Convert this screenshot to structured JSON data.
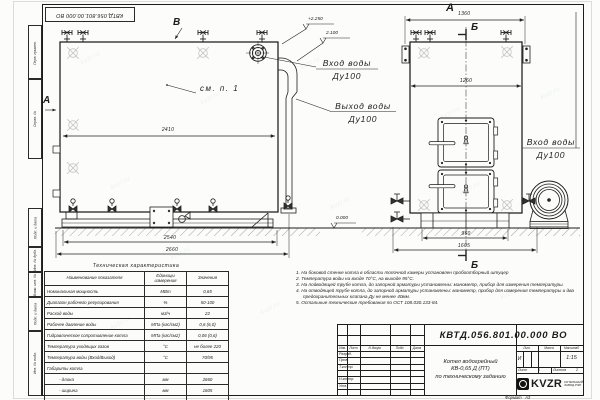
{
  "doc_number": "КВТД.056.801.00.000  ВО",
  "watermark": "kvzr.ru",
  "margin_labels": [
    "Перв. примен.",
    "Справ. №",
    "Подп. и дата",
    "Инв. № дубл.",
    "Взам. инв. №",
    "Подп. и дата",
    "Инв. № подл."
  ],
  "views": {
    "view_b": "В",
    "section_a": "А",
    "view_a": "А",
    "section_b_top": "Б",
    "section_b_bottom": "Б",
    "see_note": "см. п. 1",
    "dims": {
      "d2410": "2410",
      "d2540": "2540",
      "d2660": "2660",
      "d1360": "1360",
      "d1260": "1260",
      "d960": "960",
      "d1605": "1605"
    },
    "elevations": {
      "top": "+2.250",
      "mid": "2.100",
      "zero": "0.000"
    },
    "ports": {
      "inlet_left": [
        "Вход воды",
        "Ду100"
      ],
      "outlet": [
        "Выход воды",
        "Ду100"
      ],
      "inlet_right": [
        "Вход воды",
        "Ду100"
      ]
    }
  },
  "table": {
    "title": "Техническая характеристика",
    "headers": [
      "Наименование показателя",
      "Единицы измерения",
      "Значения"
    ],
    "rows": [
      [
        "Номинальная мощность",
        "МВт",
        "0,65"
      ],
      [
        "Диапазон рабочего регулирования",
        "%",
        "50-100"
      ],
      [
        "Расход воды",
        "м3/ч",
        "22"
      ],
      [
        "Рабочее давление воды",
        "МПа (кгс/см2)",
        "0,6 (6,0)"
      ],
      [
        "Гидравлическое сопротивление котла",
        "МПа (кгс/см2)",
        "0,06 (0,6)"
      ],
      [
        "Температура уходящих газов",
        "°С",
        "не более 220"
      ],
      [
        "Температура воды (Вход/Выход)",
        "°С",
        "70/95"
      ],
      [
        "Габариты котла",
        "",
        ""
      ],
      [
        "- длина",
        "мм",
        "2660"
      ],
      [
        "- ширина",
        "мм",
        "1605"
      ],
      [
        "- высота",
        "мм",
        "2250"
      ]
    ]
  },
  "notes": [
    "1.  На боковой стенке котла в области топочной камеры установлен пробоотборный штуцер",
    "2.  Температура воды на входе 70°С, на выходе 95°С.",
    "3.  На подводящей трубе котла, до запорной арматуры установлены: манометр, прибор для измерения температуры.",
    "4.  На отводящей трубе котла, до запорной арматуры установлены: манометр, прибор для измерения температуры и два предохранительных клапана Ду не менее 40мм.",
    "5.  Остальные технические требования по ОСТ 108.030.133-84."
  ],
  "title_block": {
    "product_line1": "Котел водогрейный",
    "product_line2": "КВ-0,65  Д  (ПТ)",
    "product_line3": "по техническому заданию",
    "change_headers": [
      "Изм.",
      "Лист",
      "N докум.",
      "Подп.",
      "Дата"
    ],
    "roles": [
      "Разраб.",
      "Пров.",
      "Т.контр.",
      "Н.контр.",
      "Утв."
    ],
    "lit_header": "Лит.",
    "mass_header": "Масса",
    "scale_header": "Масштаб",
    "lit_value": "И",
    "scale_value": "1:15",
    "sheet_label": "Лист",
    "sheet_value": "1",
    "sheets_label": "Листов",
    "sheets_value": "2",
    "brand": "KVZR",
    "brand_sub1": "КОТЕЛЬНЫЙ",
    "brand_sub2": "ЗАВОД РЭП",
    "format_label": "Формат",
    "format_value": "А3"
  }
}
